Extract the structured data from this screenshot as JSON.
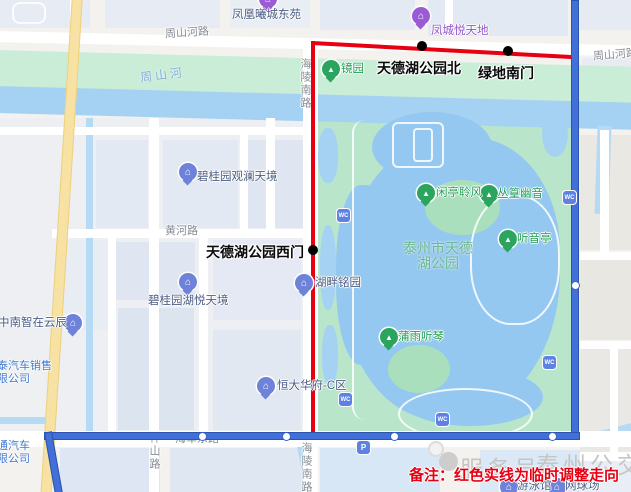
{
  "map": {
    "note": "备注：红色实线为临时调整走向",
    "watermark": {
      "part1": "服务号",
      "part2": "泰州公交"
    },
    "colors": {
      "temporary_route": "#e60012",
      "regular_route": "#4070d8",
      "park_green": "#b9e6ca",
      "water_blue": "#a5d2f3"
    },
    "stops": [
      {
        "name": "天德湖公园北"
      },
      {
        "name": "绿地南门"
      },
      {
        "name": "天德湖公园西门"
      }
    ],
    "roads": {
      "zhoushanhe_rd_left": "周山河路",
      "zhoushanhe_rd_right": "周山河路",
      "huanghe_rd": "黄河路",
      "haijun_east_rd": "海军东路",
      "shenshan_rd": "神山路",
      "hailing_south_rd_top": "海陵南路",
      "hailing_south_rd_bottom": "海陵南路"
    },
    "river": "周山河",
    "park": {
      "title_line1": "泰州市天德",
      "title_line2": "湖公园",
      "spots": [
        "镜园",
        "闲亭聆风",
        "丛篁幽音",
        "听音亭",
        "蒲雨听琴"
      ]
    },
    "places": [
      "凤凰曦城东苑",
      "凤城悦天地",
      "碧桂园观澜天境",
      "中南智在云辰",
      "碧桂园湖悦天境",
      "恒大华府-C区",
      "湖畔铭园"
    ],
    "partial": {
      "tai_auto_line1": "泰汽车销售",
      "tai_auto_line2": "限公司",
      "tong_auto_line1": "通汽车",
      "tong_auto_line2": "限公司"
    },
    "facilities": [
      "游泳馆",
      "网球场"
    ]
  }
}
